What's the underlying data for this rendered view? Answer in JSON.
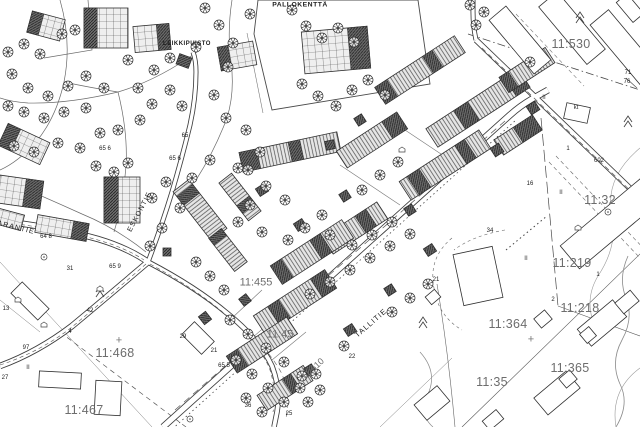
{
  "map": {
    "areas": [
      {
        "name": "PALLOKENTTÄ"
      },
      {
        "name": "LEIKKIPUISTO"
      }
    ],
    "streets": [
      {
        "name": "TALLITIE"
      },
      {
        "name": "ESKONTIE"
      },
      {
        "name": "ARANTIE"
      }
    ],
    "parcels": [
      {
        "id": "11:530"
      },
      {
        "id": "11:32"
      },
      {
        "id": "11:219"
      },
      {
        "id": "11:218"
      },
      {
        "id": "11:364"
      },
      {
        "id": "11:365"
      },
      {
        "id": "11:35"
      },
      {
        "id": "11:468"
      },
      {
        "id": "11:467"
      },
      {
        "id": "11:455"
      },
      {
        "id": "11:45"
      },
      {
        "id": "11:610"
      }
    ],
    "plot_numbers": [
      "602",
      "64 8",
      "65",
      "65 6",
      "65 6",
      "65 9",
      "31",
      "29",
      "21",
      "36",
      "25",
      "22",
      "21",
      "34",
      "16",
      "1",
      "2",
      "1",
      "42",
      "13",
      "4",
      "97",
      "27",
      "76",
      "71",
      "65 5"
    ],
    "building_marks": [
      {
        "text": "kt"
      },
      {
        "text": "II"
      },
      {
        "text": "II"
      },
      {
        "text": "II"
      },
      {
        "text": "II"
      }
    ],
    "symbols": [
      {
        "text": "+"
      },
      {
        "text": "+"
      }
    ],
    "colors": {
      "line": "#3c3c3c",
      "parcel_label": "#6d6d6d",
      "building_dark": "#6d6d6d",
      "building_light": "#e6e6e6"
    }
  }
}
